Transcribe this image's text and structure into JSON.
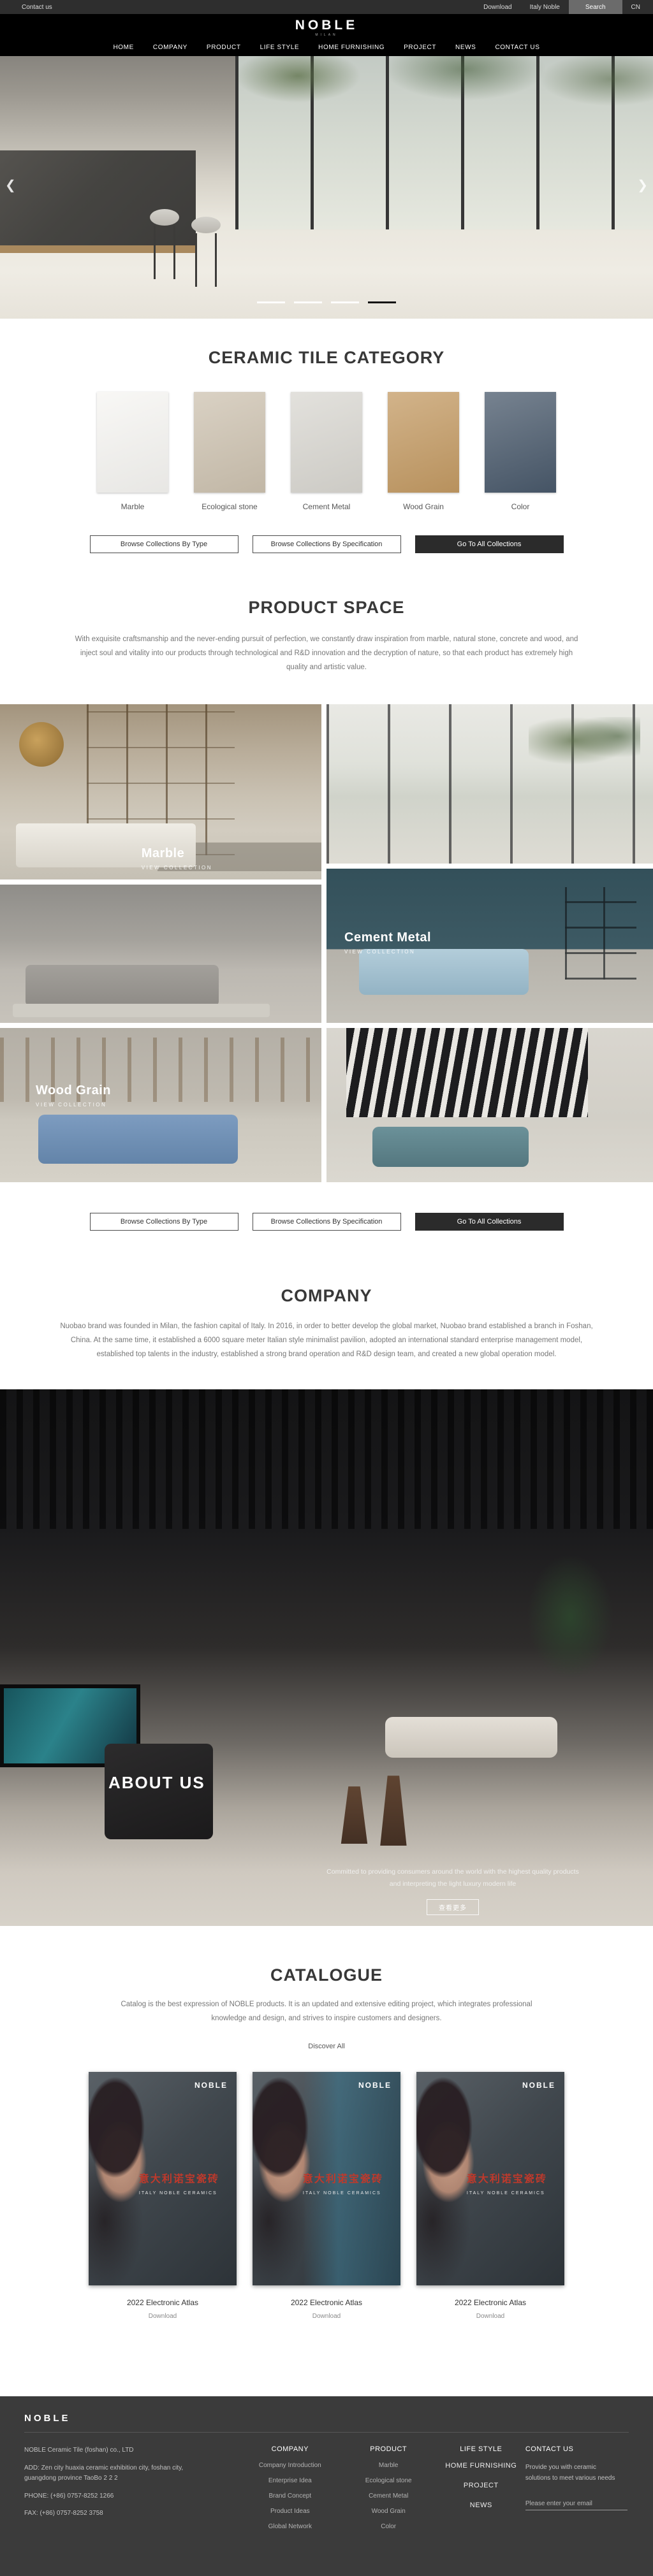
{
  "topbar": {
    "contact": "Contact us",
    "download": "Download",
    "italy": "Italy Noble",
    "search": "Search",
    "lang": "CN"
  },
  "header": {
    "logo": "NOBLE",
    "milan": "MILAN"
  },
  "nav": {
    "items": [
      {
        "label": "HOME"
      },
      {
        "label": "COMPANY"
      },
      {
        "label": "PRODUCT"
      },
      {
        "label": "LIFE STYLE"
      },
      {
        "label": "HOME FURNISHING"
      },
      {
        "label": "PROJECT"
      },
      {
        "label": "NEWS"
      },
      {
        "label": "CONTACT US"
      }
    ]
  },
  "hero": {
    "prev": "❮",
    "next": "❯",
    "slide_count": 4,
    "active_slide": 4
  },
  "category": {
    "title": "CERAMIC TILE CATEGORY",
    "items": [
      {
        "label": "Marble",
        "color": "#f6f5f2"
      },
      {
        "label": "Ecological stone",
        "color": "#cdc2b0"
      },
      {
        "label": "Cement Metal",
        "color": "#d9d7d1"
      },
      {
        "label": "Wood Grain",
        "color": "#c39a63"
      },
      {
        "label": "Color",
        "color": "#49596b"
      }
    ]
  },
  "collections": {
    "by_type": "Browse Collections By Type",
    "by_spec": "Browse Collections By Specification",
    "go_all": "Go To All Collections"
  },
  "product_space": {
    "title": "PRODUCT SPACE",
    "description": "With exquisite craftsmanship and the never-ending pursuit of perfection, we constantly draw inspiration from marble, natural stone, concrete and wood, and inject soul and vitality into our products through technological and R&D innovation and the decryption of nature, so that each product has extremely high quality and artistic value."
  },
  "gallery": {
    "marble": {
      "title": "Marble",
      "subtitle": "VIEW COLLECTION"
    },
    "cement": {
      "title": "Cement Metal",
      "subtitle": "VIEW COLLECTION"
    },
    "wood": {
      "title": "Wood Grain",
      "subtitle": "VIEW COLLECTION"
    }
  },
  "company": {
    "title": "COMPANY",
    "description": "Nuobao brand was founded in Milan, the fashion capital of Italy. In 2016, in order to better develop the global market, Nuobao brand established a branch in Foshan, China. At the same time, it established a 6000 square meter Italian style minimalist pavilion, adopted an international standard enterprise management model, established top talents in the industry, established a strong brand operation and R&D design team, and created a new global operation model."
  },
  "about": {
    "title": "ABOUT US",
    "line1": "Committed to providing consumers around the world with the highest quality products",
    "line2": "and interpreting the light luxury modern life",
    "more": "查看更多"
  },
  "catalogue": {
    "title": "CATALOGUE",
    "description": "Catalog is the best expression of NOBLE products. It is an updated and extensive editing project, which integrates professional knowledge and design, and strives to inspire customers and designers.",
    "discover": "Discover All",
    "covers": [
      {
        "brand": "NOBLE",
        "title_cjk": "意大利诺宝瓷砖",
        "subtitle": "ITALY NOBLE CERAMICS"
      },
      {
        "brand": "NOBLE",
        "title_cjk": "意大利诺宝瓷砖",
        "subtitle": "ITALY NOBLE CERAMICS"
      },
      {
        "brand": "NOBLE",
        "title_cjk": "意大利诺宝瓷砖",
        "subtitle": "ITALY NOBLE CERAMICS"
      }
    ],
    "items": [
      {
        "label": "2022 Electronic Atlas",
        "download": "Download"
      },
      {
        "label": "2022 Electronic Atlas",
        "download": "Download"
      },
      {
        "label": "2022 Electronic Atlas",
        "download": "Download"
      }
    ]
  },
  "footer": {
    "logo": "NOBLE",
    "info": {
      "company": "NOBLE Ceramic Tile (foshan) co., LTD",
      "address": "ADD:  Zen city huaxia ceramic exhibition city, foshan city, guangdong province TaoBo 2 2 2",
      "phone": "PHONE:   (+86)  0757-8252 1266",
      "fax": "FAX:   (+86)  0757-8252 3758"
    },
    "company_col": {
      "header": "COMPANY",
      "links": [
        "Company Introduction",
        "Enterprise Idea",
        "Brand Concept",
        "Product Ideas",
        "Global Network"
      ]
    },
    "product_col": {
      "header": "PRODUCT",
      "links": [
        "Marble",
        "Ecological stone",
        "Cement Metal",
        "Wood Grain",
        "Color"
      ]
    },
    "explore_col": {
      "header": "LIFE STYLE",
      "links": [
        "HOME FURNISHING",
        "PROJECT",
        "NEWS"
      ]
    },
    "contact_col": {
      "header": "CONTACT US",
      "text": "Provide you with ceramic solutions to meet various needs",
      "email_placeholder": "Please enter your email"
    }
  },
  "colors": {
    "accent_dark_button": "#2b2b2b",
    "footer_bg": "#3b3b3b",
    "cover_red": "#c0392b"
  }
}
